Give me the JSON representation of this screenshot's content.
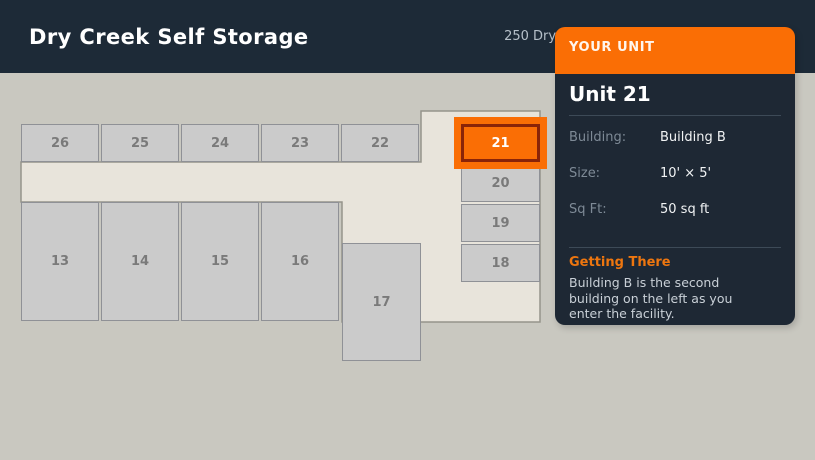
{
  "header": {
    "title": "Dry Creek Self Storage",
    "address": "250 Dry Creek Rd, Morehead, KY 40351"
  },
  "map": {
    "selected_unit": "21",
    "units": [
      {
        "id": "26",
        "x": 21,
        "y": 51,
        "w": 78,
        "h": 38,
        "selected": false
      },
      {
        "id": "25",
        "x": 101,
        "y": 51,
        "w": 78,
        "h": 38,
        "selected": false
      },
      {
        "id": "24",
        "x": 181,
        "y": 51,
        "w": 78,
        "h": 38,
        "selected": false
      },
      {
        "id": "23",
        "x": 261,
        "y": 51,
        "w": 78,
        "h": 38,
        "selected": false
      },
      {
        "id": "22",
        "x": 341,
        "y": 51,
        "w": 78,
        "h": 38,
        "selected": false
      },
      {
        "id": "21",
        "x": 461,
        "y": 51,
        "w": 79,
        "h": 38,
        "selected": true
      },
      {
        "id": "20",
        "x": 461,
        "y": 91,
        "w": 79,
        "h": 38,
        "selected": false
      },
      {
        "id": "19",
        "x": 461,
        "y": 131,
        "w": 79,
        "h": 38,
        "selected": false
      },
      {
        "id": "18",
        "x": 461,
        "y": 171,
        "w": 79,
        "h": 38,
        "selected": false
      },
      {
        "id": "13",
        "x": 21,
        "y": 129,
        "w": 78,
        "h": 119,
        "selected": false
      },
      {
        "id": "14",
        "x": 101,
        "y": 129,
        "w": 78,
        "h": 119,
        "selected": false
      },
      {
        "id": "15",
        "x": 181,
        "y": 129,
        "w": 78,
        "h": 119,
        "selected": false
      },
      {
        "id": "16",
        "x": 261,
        "y": 129,
        "w": 78,
        "h": 119,
        "selected": false
      },
      {
        "id": "17",
        "x": 342,
        "y": 170,
        "w": 79,
        "h": 118,
        "selected": false
      }
    ]
  },
  "panel": {
    "header_label": "YOUR UNIT",
    "title": "Unit 21",
    "details": [
      {
        "label": "Building:",
        "value": "Building B"
      },
      {
        "label": "Size:",
        "value": "10' × 5'"
      },
      {
        "label": "Sq Ft:",
        "value": "50 sq ft"
      }
    ],
    "getting_there": {
      "title": "Getting There",
      "text": "Building B is the second building on the left as you enter the facility."
    }
  },
  "colors": {
    "accent_orange": "#fa6e05",
    "selected_border": "#8a2408",
    "header_bg": "#1d2a37",
    "panel_bg": "#1e2834",
    "page_bg": "#c9c8c0",
    "building_fill": "#e8e4db",
    "unit_fill": "#cbcbcb"
  }
}
